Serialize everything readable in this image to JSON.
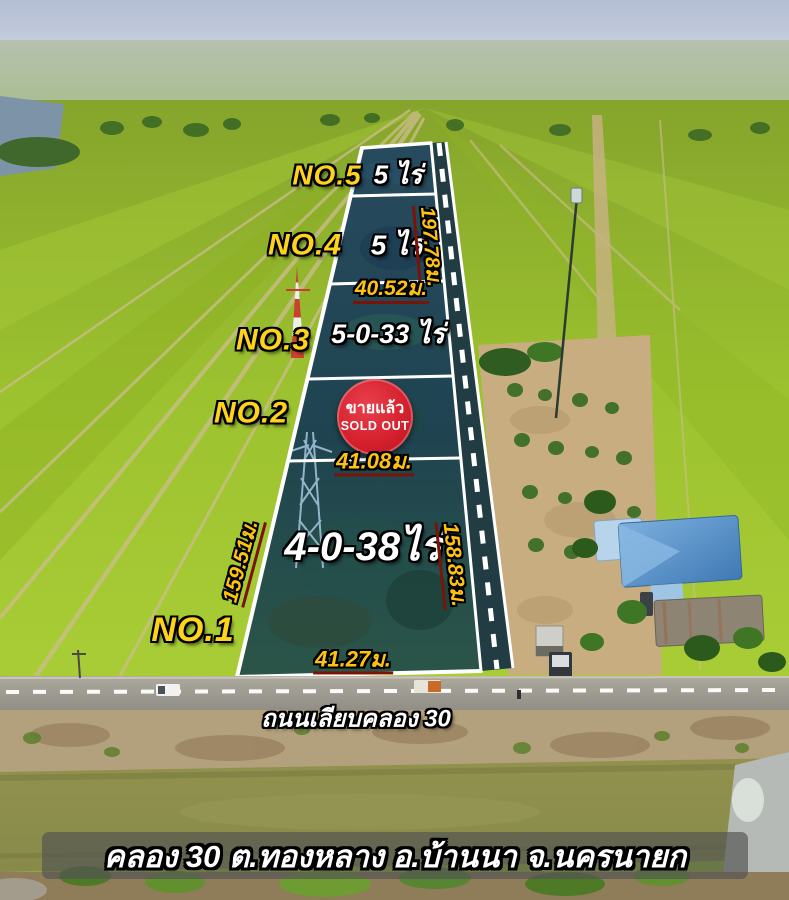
{
  "plots": [
    {
      "no": "NO.5",
      "size": "5 ไร่"
    },
    {
      "no": "NO.4",
      "size": "5 ไร่"
    },
    {
      "no": "NO.3",
      "size": "5-0-33 ไร่"
    },
    {
      "no": "NO.2",
      "size": ""
    },
    {
      "no": "NO.1",
      "size": "4-0-38ไร่"
    }
  ],
  "measurements": {
    "right_upper": "197.78ม.",
    "between_no4_no3": "40.52ม.",
    "between_no2_no1": "41.08ม.",
    "left_side": "159.51ม.",
    "right_lower": "158.83ม.",
    "road_frontage": "41.27ม."
  },
  "sold_badge": {
    "thai": "ขายแล้ว",
    "english": "SOLD OUT"
  },
  "road_label": "ถนนเลียบคลอง 30",
  "location_banner": "คลอง 30 ต.ทองหลาง อ.บ้านนา จ.นครนายก",
  "colors": {
    "plot_number_yellow": "#ffd21c",
    "measurement_yellow": "#ffc30f",
    "size_text_white": "#ffffff",
    "sold_badge_red": "#d6212e",
    "boundary_line_white": "#ffffff"
  }
}
